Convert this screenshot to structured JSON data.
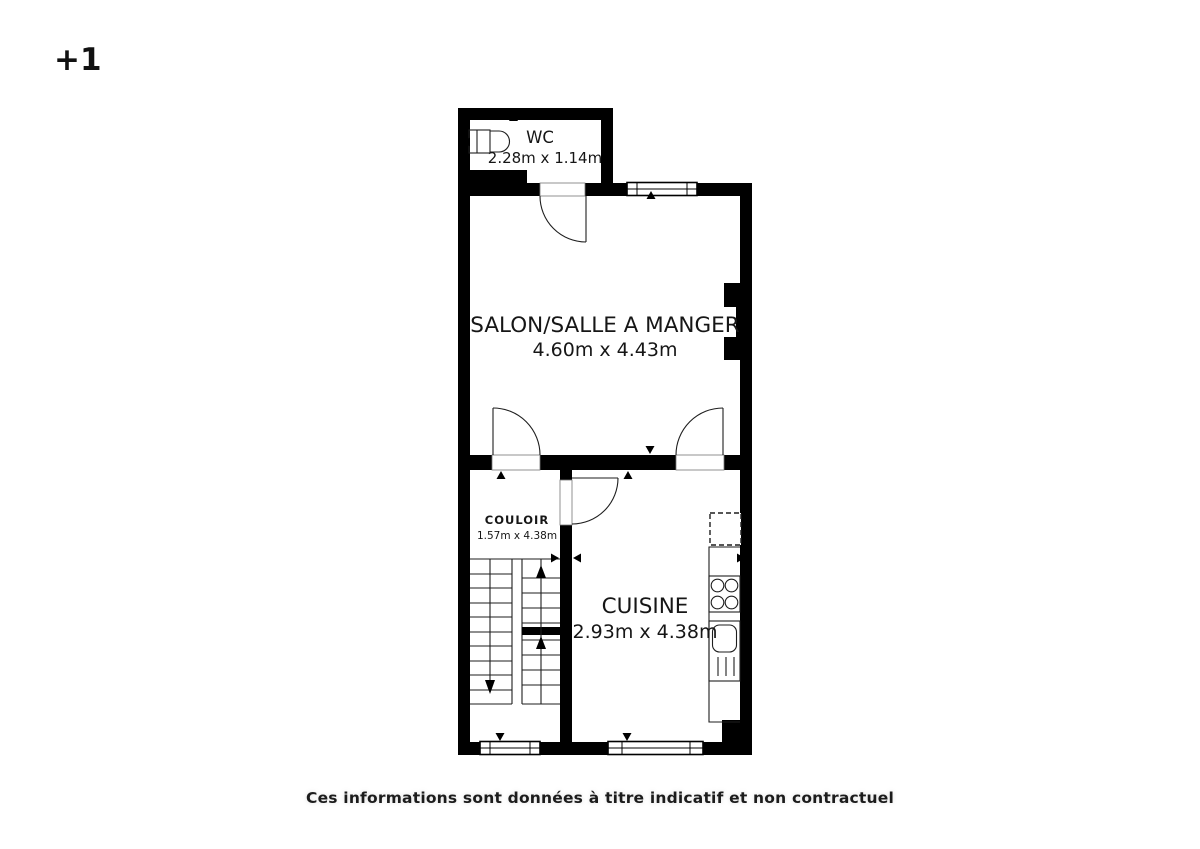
{
  "page": {
    "background": "#ffffff",
    "wall_color": "#000000",
    "line_color": "#1e1e1e",
    "text_color": "#161616"
  },
  "floor_label": "+1",
  "disclaimer": "Ces informations sont données à titre indicatif et non contractuel",
  "plan": {
    "rooms": {
      "wc": {
        "name": "WC",
        "dimensions": "2.28m x 1.14m"
      },
      "salon": {
        "name": "SALON/SALLE A MANGER",
        "dimensions": "4.60m x 4.43m"
      },
      "couloir": {
        "name": "COULOIR",
        "dimensions": "1.57m x 4.38m"
      },
      "cuisine": {
        "name": "CUISINE",
        "dimensions": "2.93m x 4.38m"
      }
    },
    "icons": {
      "toilet-icon": "toilet tank + bowl, WC room",
      "staircase-icon": "U-shaped stair, down arrow left flight, up arrows right flight",
      "stove-icon": "4-burner cooktop on kitchen counter",
      "sink-icon": "kitchen sink with drainboard lines",
      "fridge-icon": "dashed appliance square on counter",
      "door-swing-icon": "quarter-circle door arcs (4 doors)",
      "window-icon": "double-line windows (3 windows)",
      "measure-arrow-icon": "black triangle dimension markers on walls"
    }
  }
}
